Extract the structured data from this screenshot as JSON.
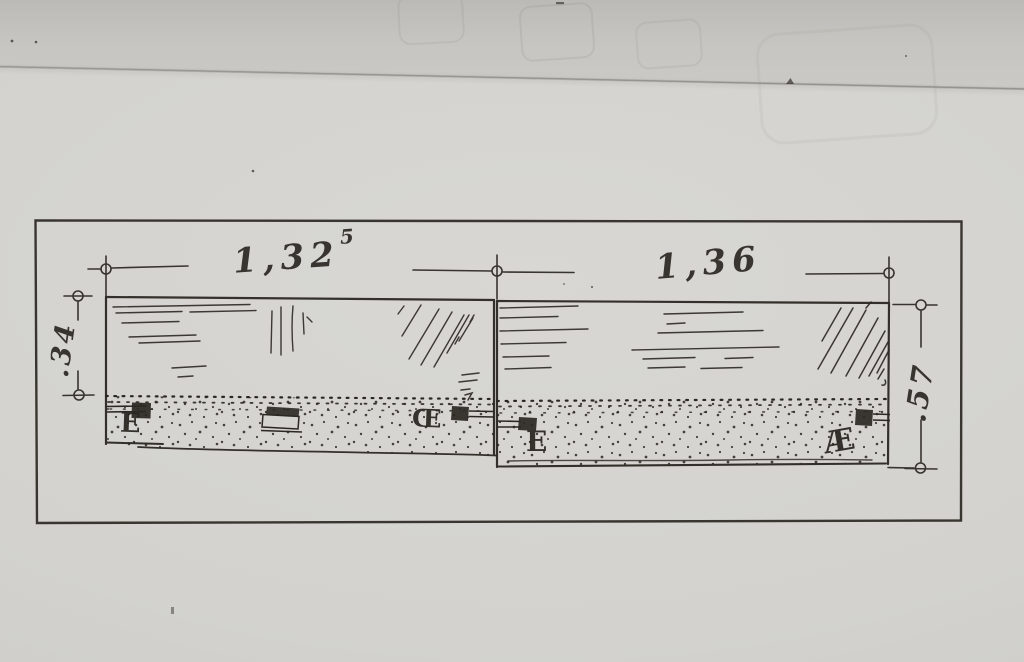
{
  "photo": {
    "drawing": {
      "dimension_labels": {
        "top_left": {
          "main": "1,32",
          "superscript": "5"
        },
        "top_right": {
          "main": "1,36",
          "superscript": ""
        },
        "left_height": ".34",
        "right_height": ".57"
      },
      "find_labels": {
        "left_panel_west": "E",
        "left_panel_east": "Œ",
        "right_panel_west": "E",
        "right_panel_east": "Æ"
      }
    }
  },
  "colors": {
    "paper": "#d4d3cf",
    "paper-top": "#c6c5c1",
    "ink": "#2b2722"
  }
}
